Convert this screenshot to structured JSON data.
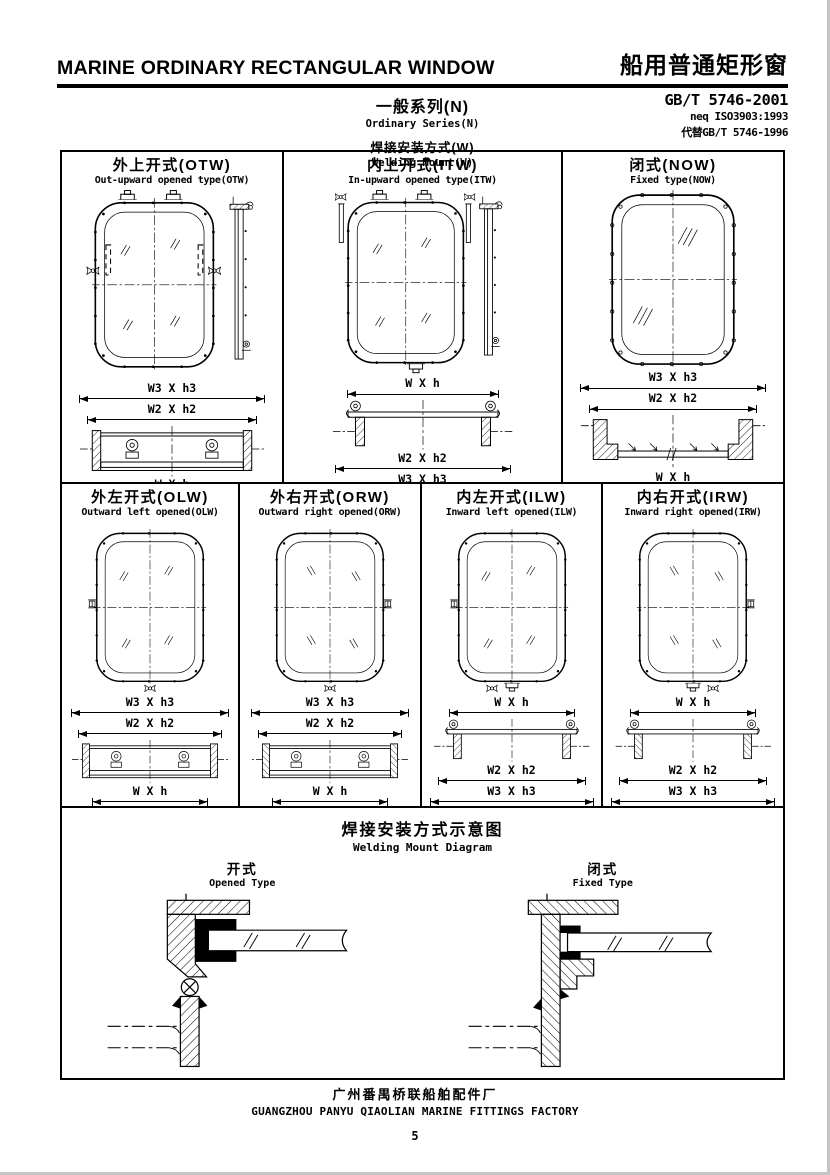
{
  "colors": {
    "ink": "#000000",
    "paper": "#ffffff"
  },
  "header": {
    "title_en": "MARINE ORDINARY RECTANGULAR WINDOW",
    "title_zh": "船用普通矩形窗",
    "standard": "GB/T 5746-2001",
    "standard_neq": "neq ISO3903:1993",
    "standard_replaces": "代替GB/T 5746-1996",
    "series_zh": "一般系列(N)",
    "series_en": "Ordinary Series(N)",
    "mount_zh": "焊接安装方式(W)",
    "mount_en": "Welding Mount(W)"
  },
  "panels": {
    "row1": [
      {
        "title_zh": "外上开式(OTW)",
        "title_en": "Out-upward opened type(OTW)",
        "dims": [
          "W3 X h3",
          "W2 X h2",
          "W X h"
        ]
      },
      {
        "title_zh": "内上开式(ITW)",
        "title_en": "In-upward opened type(ITW)",
        "dims": [
          "W X h",
          "W2 X h2",
          "W3 X h3"
        ]
      },
      {
        "title_zh": "闭式(NOW)",
        "title_en": "Fixed type(NOW)",
        "dims": [
          "W3 X h3",
          "W2 X h2",
          "W X h"
        ]
      }
    ],
    "row2": [
      {
        "title_zh": "外左开式(OLW)",
        "title_en": "Outward left opened(OLW)",
        "dims": [
          "W3 X h3",
          "W2 X h2",
          "W X h"
        ]
      },
      {
        "title_zh": "外右开式(ORW)",
        "title_en": "Outward right opened(ORW)",
        "dims": [
          "W3 X h3",
          "W2 X h2",
          "W X h"
        ]
      },
      {
        "title_zh": "内左开式(ILW)",
        "title_en": "Inward left opened(ILW)",
        "dims": [
          "W X h",
          "W2 X h2",
          "W3 X h3"
        ]
      },
      {
        "title_zh": "内右开式(IRW)",
        "title_en": "Inward right opened(IRW)",
        "dims": [
          "W X h",
          "W2 X h2",
          "W3 X h3"
        ]
      }
    ],
    "welding": {
      "title_zh": "焊接安装方式示意图",
      "title_en": "Welding Mount Diagram",
      "left_zh": "开式",
      "left_en": "Opened Type",
      "right_zh": "闭式",
      "right_en": "Fixed Type"
    }
  },
  "footer": {
    "factory_zh": "广州番禺桥联船舶配件厂",
    "factory_en": "GUANGZHOU PANYU QIAOLIAN MARINE FITTINGS FACTORY",
    "page": "5"
  }
}
